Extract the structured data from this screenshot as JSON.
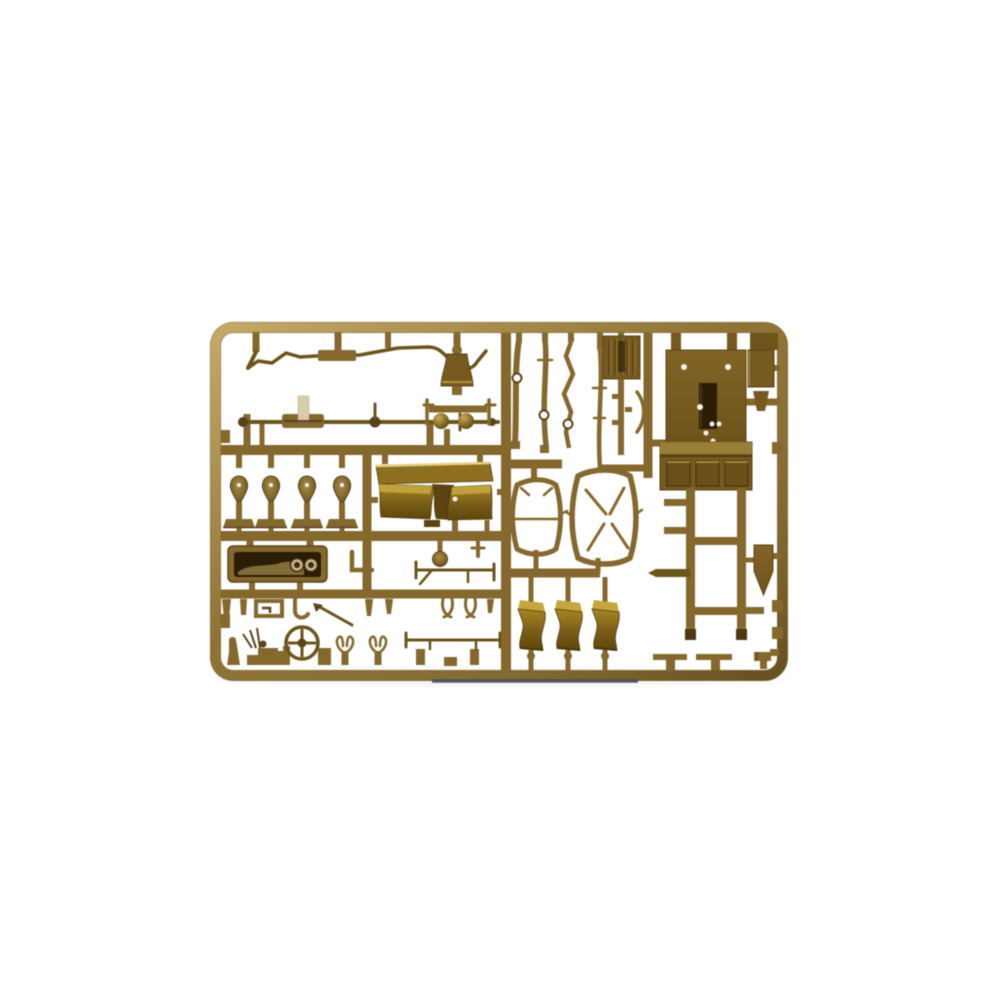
{
  "meta": {
    "type": "product-photo",
    "subject": "plastic scale-model kit sprue",
    "alt": "Olive-drab injection molded sprue (parts tree) of a military vehicle model kit, photographed on a white background"
  },
  "colors": {
    "background": "#ffffff",
    "runner": "#85682b",
    "runner_hi": "#c4a75e",
    "runner_dark": "#57421a",
    "wire": "#6b5518",
    "panel": "#77591c",
    "panel_hi": "#9a7e33",
    "recess": "#6b4f16",
    "dark": "#2c1d08",
    "gold": "#8f6f1d",
    "gold_hi": "#c5a53b",
    "gold_edge": "#e4cf86",
    "gold_dark": "#5c4410",
    "cream": "#d8cba8",
    "dial": "#c9b488",
    "hole": "#f7f3e7",
    "subsprue": "#474c5c"
  },
  "sprue": {
    "material": "olive drab styrene",
    "frame_shape": "rounded rectangle",
    "parts": [
      {
        "name": "wire-linkage",
        "desc": "bent wire / exhaust pipe part, top left"
      },
      {
        "name": "tie-rod-axle",
        "desc": "long steering rod with center block and light gate"
      },
      {
        "name": "lamp-funnel",
        "desc": "flared horn / lamp housing, top center"
      },
      {
        "name": "headlight-pair",
        "desc": "two round headlights on a T runner"
      },
      {
        "name": "spring-hangers",
        "desc": "four teardrop stands with T feet"
      },
      {
        "name": "bench-seat",
        "desc": "gold double seat with backrest"
      },
      {
        "name": "dashboard",
        "desc": "instrument panel with two dials"
      },
      {
        "name": "fittings-row",
        "desc": "row of small pegs, hooks and buckle"
      },
      {
        "name": "steering-wheel",
        "desc": "four-spoke steering wheel between posts"
      },
      {
        "name": "fork-mounts",
        "desc": "two small Y-shaped forks"
      },
      {
        "name": "towing-rod",
        "desc": "long thin rod over two posts"
      },
      {
        "name": "leaf-spring-blades",
        "desc": "thin vertical blades with holes"
      },
      {
        "name": "radiator-plate",
        "desc": "ribbed rectangular plate"
      },
      {
        "name": "windshield-frame-small",
        "desc": "small open hoop frame"
      },
      {
        "name": "windshield-frame-large",
        "desc": "large open hoop frame with diagonal stays"
      },
      {
        "name": "cab-rear-panel",
        "desc": "large panel with window opening and three recessed panels"
      },
      {
        "name": "stowage-box",
        "desc": "small box on right edge"
      },
      {
        "name": "ladder-chassis",
        "desc": "two chassis rails with crossmembers"
      },
      {
        "name": "shovel-blade",
        "desc": "pointed shield-shaped blade"
      },
      {
        "name": "curved-covers",
        "desc": "three curved cushion / fender sections"
      },
      {
        "name": "bottom-fittings",
        "desc": "small T-tables, clamp and pegs on bottom runner"
      },
      {
        "name": "second-sprue-edge",
        "desc": "dark edge of another sprue below"
      }
    ]
  }
}
